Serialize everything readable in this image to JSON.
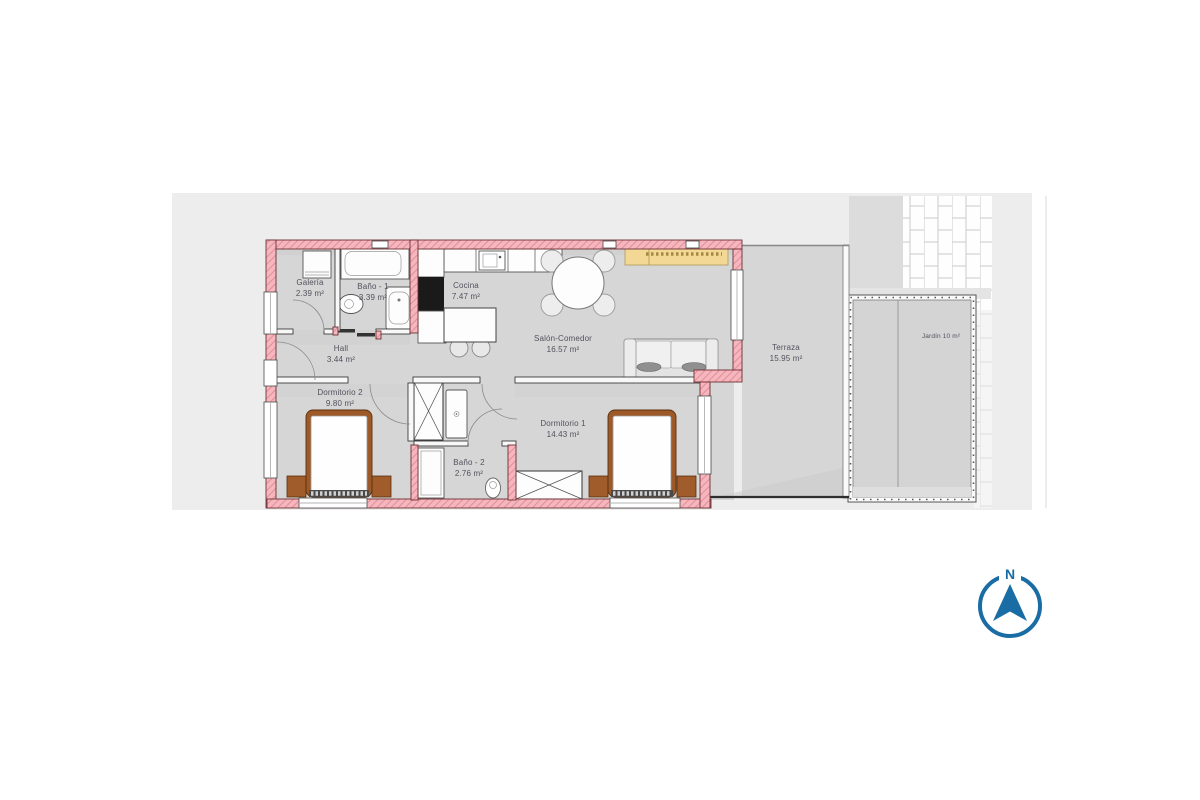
{
  "plan": {
    "rooms": [
      {
        "id": "galeria",
        "name": "Galería",
        "area": "2.39 m²"
      },
      {
        "id": "bano1",
        "name": "Baño - 1",
        "area": "3.39 m²"
      },
      {
        "id": "cocina",
        "name": "Cocina",
        "area": "7.47 m²"
      },
      {
        "id": "hall",
        "name": "Hall",
        "area": "3.44 m²"
      },
      {
        "id": "salon",
        "name": "Salón-Comedor",
        "area": "16.57 m²"
      },
      {
        "id": "dormitorio2",
        "name": "Dormitorio 2",
        "area": "9.80 m²"
      },
      {
        "id": "dormitorio1",
        "name": "Dormitorio 1",
        "area": "14.43 m²"
      },
      {
        "id": "bano2",
        "name": "Baño - 2",
        "area": "2.76 m²"
      },
      {
        "id": "terraza",
        "name": "Terraza",
        "area": "15.95 m²"
      },
      {
        "id": "jardin",
        "name": "Jardín 10 m²",
        "area": ""
      }
    ],
    "compass": {
      "label": "N"
    },
    "colors": {
      "backdrop": "#ededed",
      "floor": "#d6d6d6",
      "wall_pink": "#f5b6bd",
      "wall_hatch_line": "#dd8490",
      "wall_edge": "#6e3034",
      "sideboard_yellow": "#f3d794",
      "furniture_wood": "#9d5a28",
      "compass_blue": "#1a6da4",
      "label_text": "#52525e",
      "brick_line": "#c9c9c9"
    }
  }
}
